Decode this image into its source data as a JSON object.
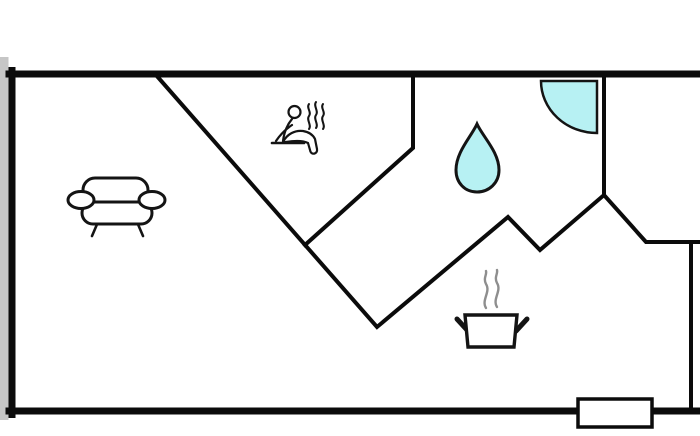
{
  "figure": {
    "type": "apartment-floor-plan",
    "title": "",
    "background": "#ffffff"
  },
  "colors": {
    "wall": "#0b0b0b",
    "icon_stroke": "#141414",
    "water": "#b7f1f3",
    "steam": "#8e8e8e",
    "shadow": "#c6c6c6",
    "door_fill": "#ffffff"
  },
  "rooms": [
    {
      "name": "living-area",
      "icon": "sofa-icon"
    },
    {
      "name": "sauna",
      "icon": "sauna-person-icon"
    },
    {
      "name": "bathroom",
      "icon": "water-drop-icon"
    },
    {
      "name": "shower-corner",
      "icon": "corner-shower-icon"
    },
    {
      "name": "kitchen",
      "icon": "cooking-pot-icon"
    }
  ],
  "markers": [
    {
      "name": "door-window-marker",
      "location": "bottom-wall-right"
    }
  ]
}
